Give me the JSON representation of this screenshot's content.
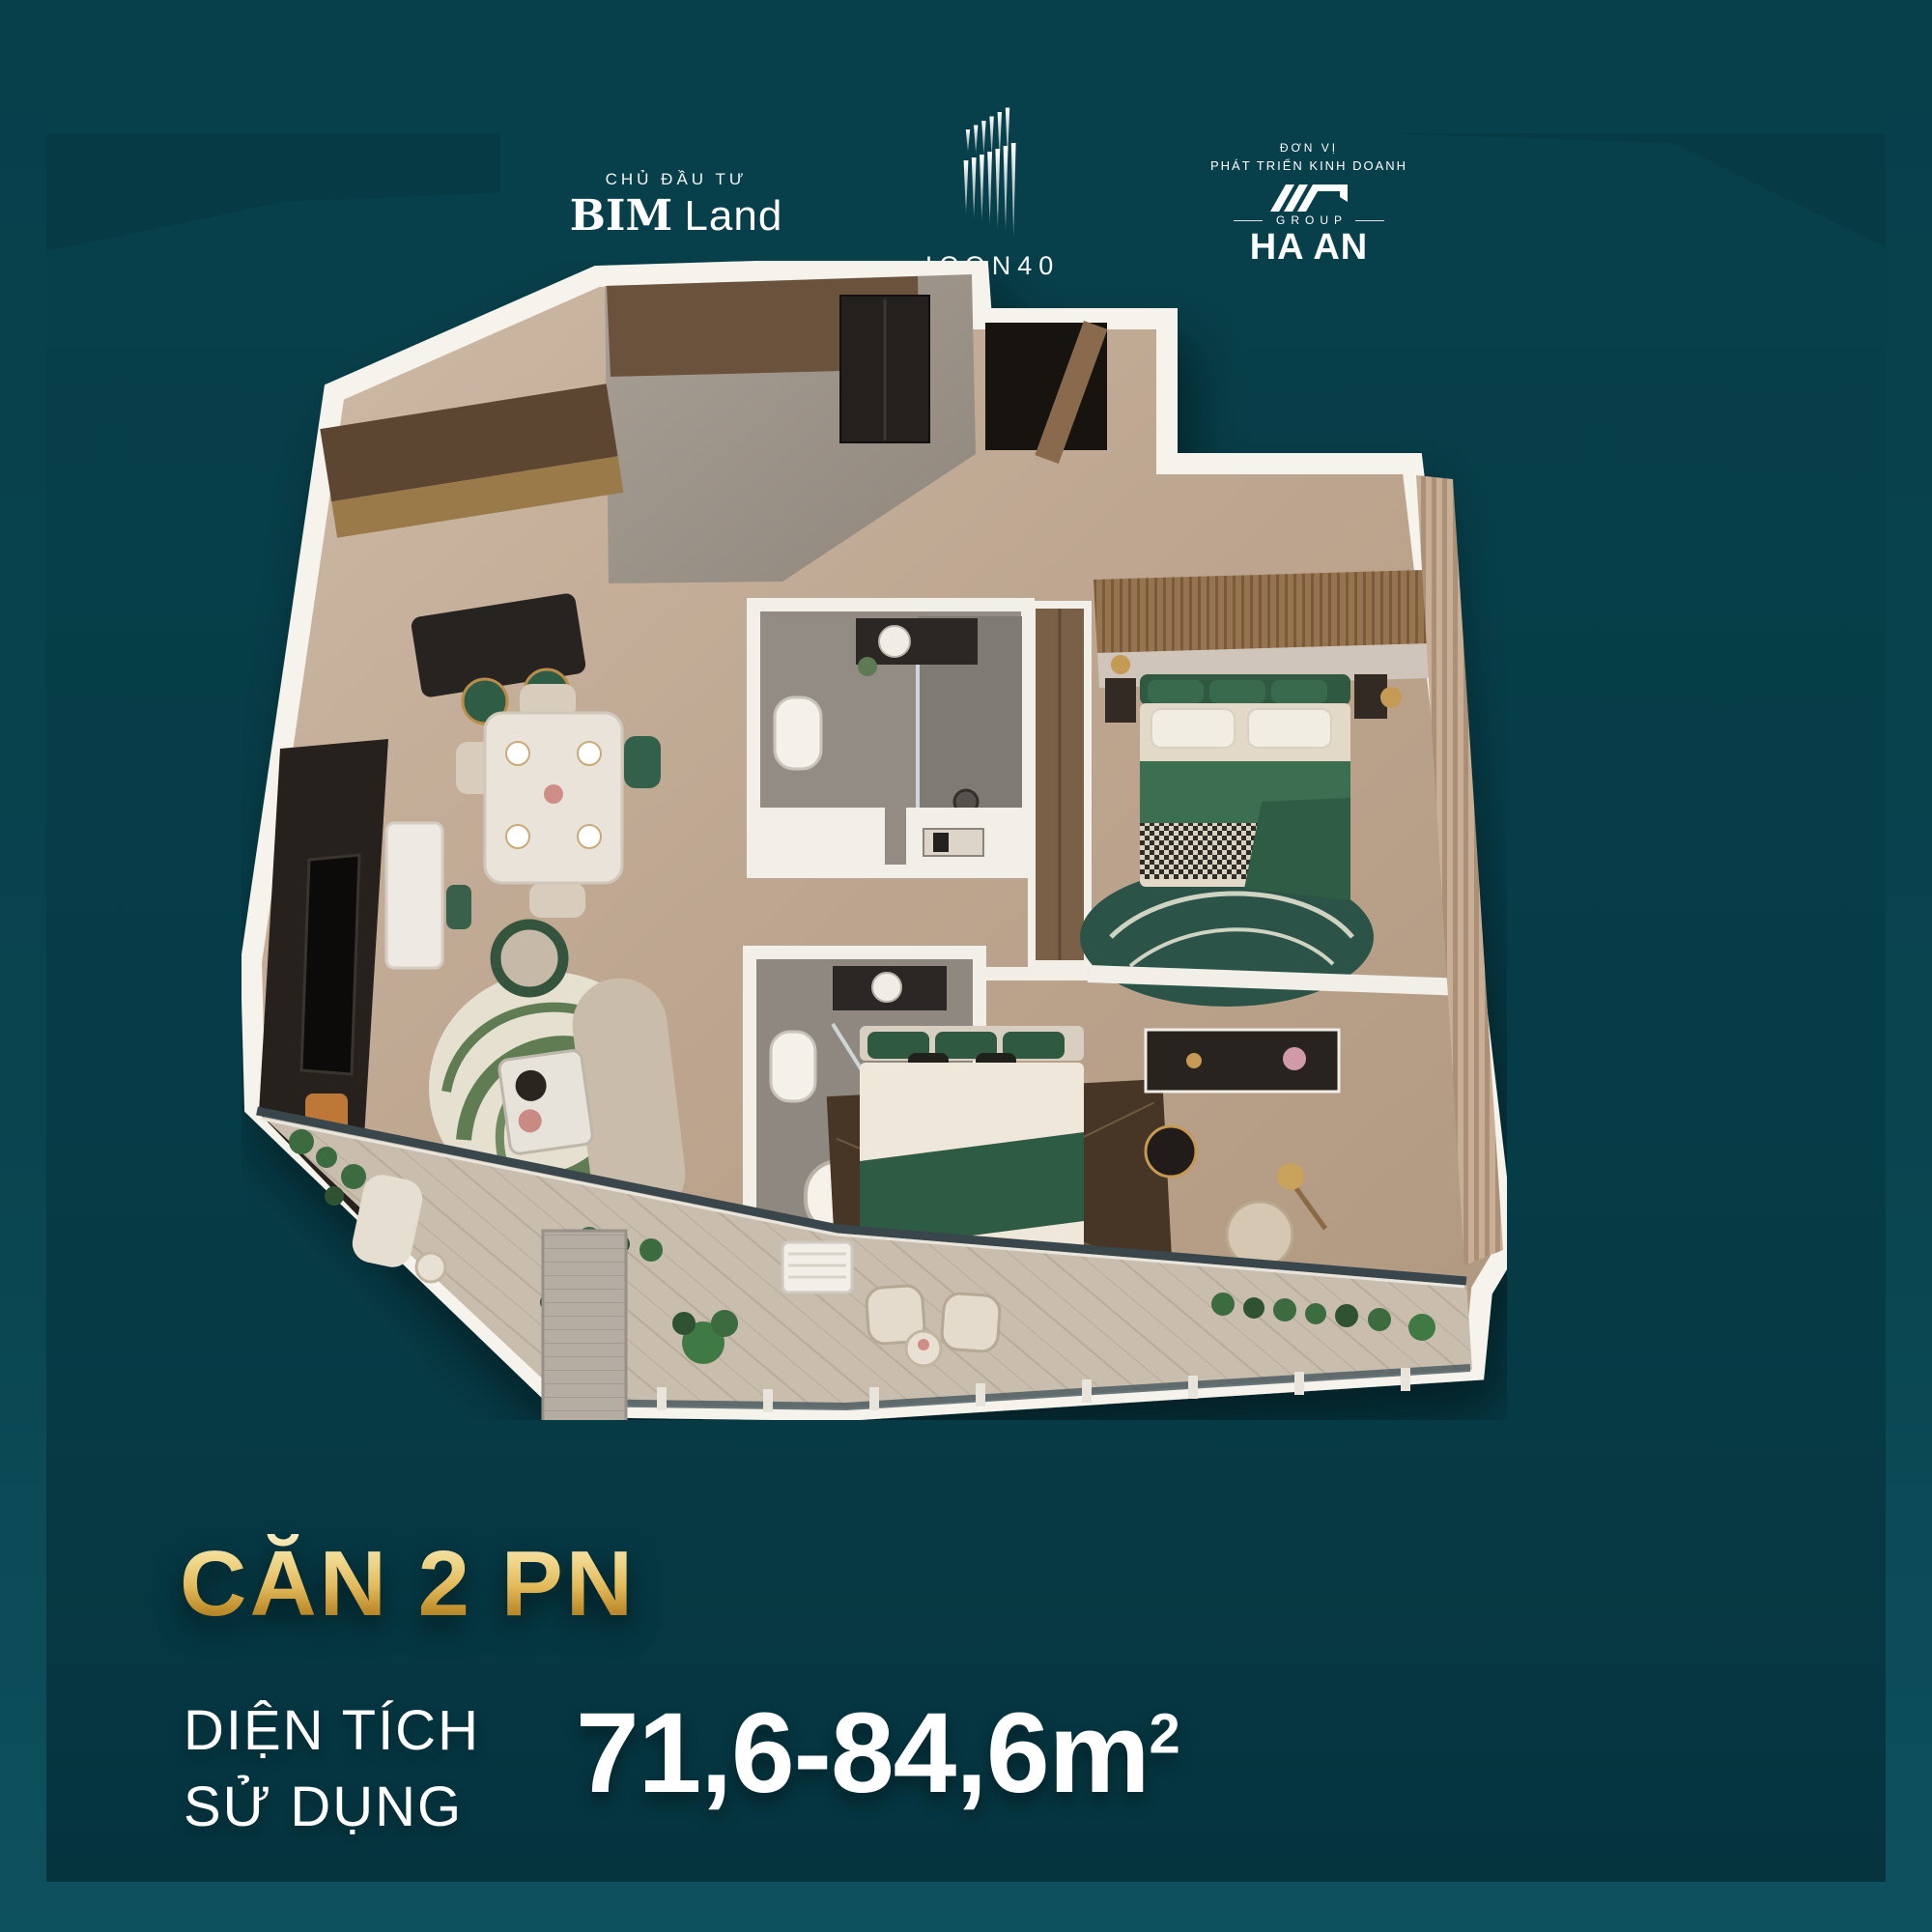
{
  "colors": {
    "background_top": "#07404B",
    "background_frame": "#0D4F5C",
    "panel_dark": "#05343F",
    "gold_accent": "#E3BA5C",
    "text_white": "#FFFFFF",
    "plan_green_accent": "#2F5A41"
  },
  "header": {
    "developer": {
      "eyebrow": "CHỦ ĐẦU TƯ",
      "name_bold": "BIM",
      "name_light": "Land",
      "icon": "bim-land-wordmark"
    },
    "project": {
      "icon": "icon40-building-icon",
      "name": "ICON40"
    },
    "business_unit": {
      "eyebrow_line1": "ĐƠN VỊ",
      "eyebrow_line2": "PHÁT TRIỂN KINH DOANH",
      "icon": "haan-roof-icon",
      "group_label": "GROUP",
      "name": "HA AN"
    }
  },
  "unit_info": {
    "unit_type": "CĂN 2 PN",
    "area_label_line1": "DIỆN TÍCH",
    "area_label_line2": "SỬ DỤNG",
    "area_value": "71,6-84,6m",
    "area_superscript": "2"
  },
  "floor_plan": {
    "description": "3D top-down render of a 2-bedroom apartment with kitchen, living-dining room, two bathrooms, two bedrooms and a wrap-around balcony with plants"
  }
}
